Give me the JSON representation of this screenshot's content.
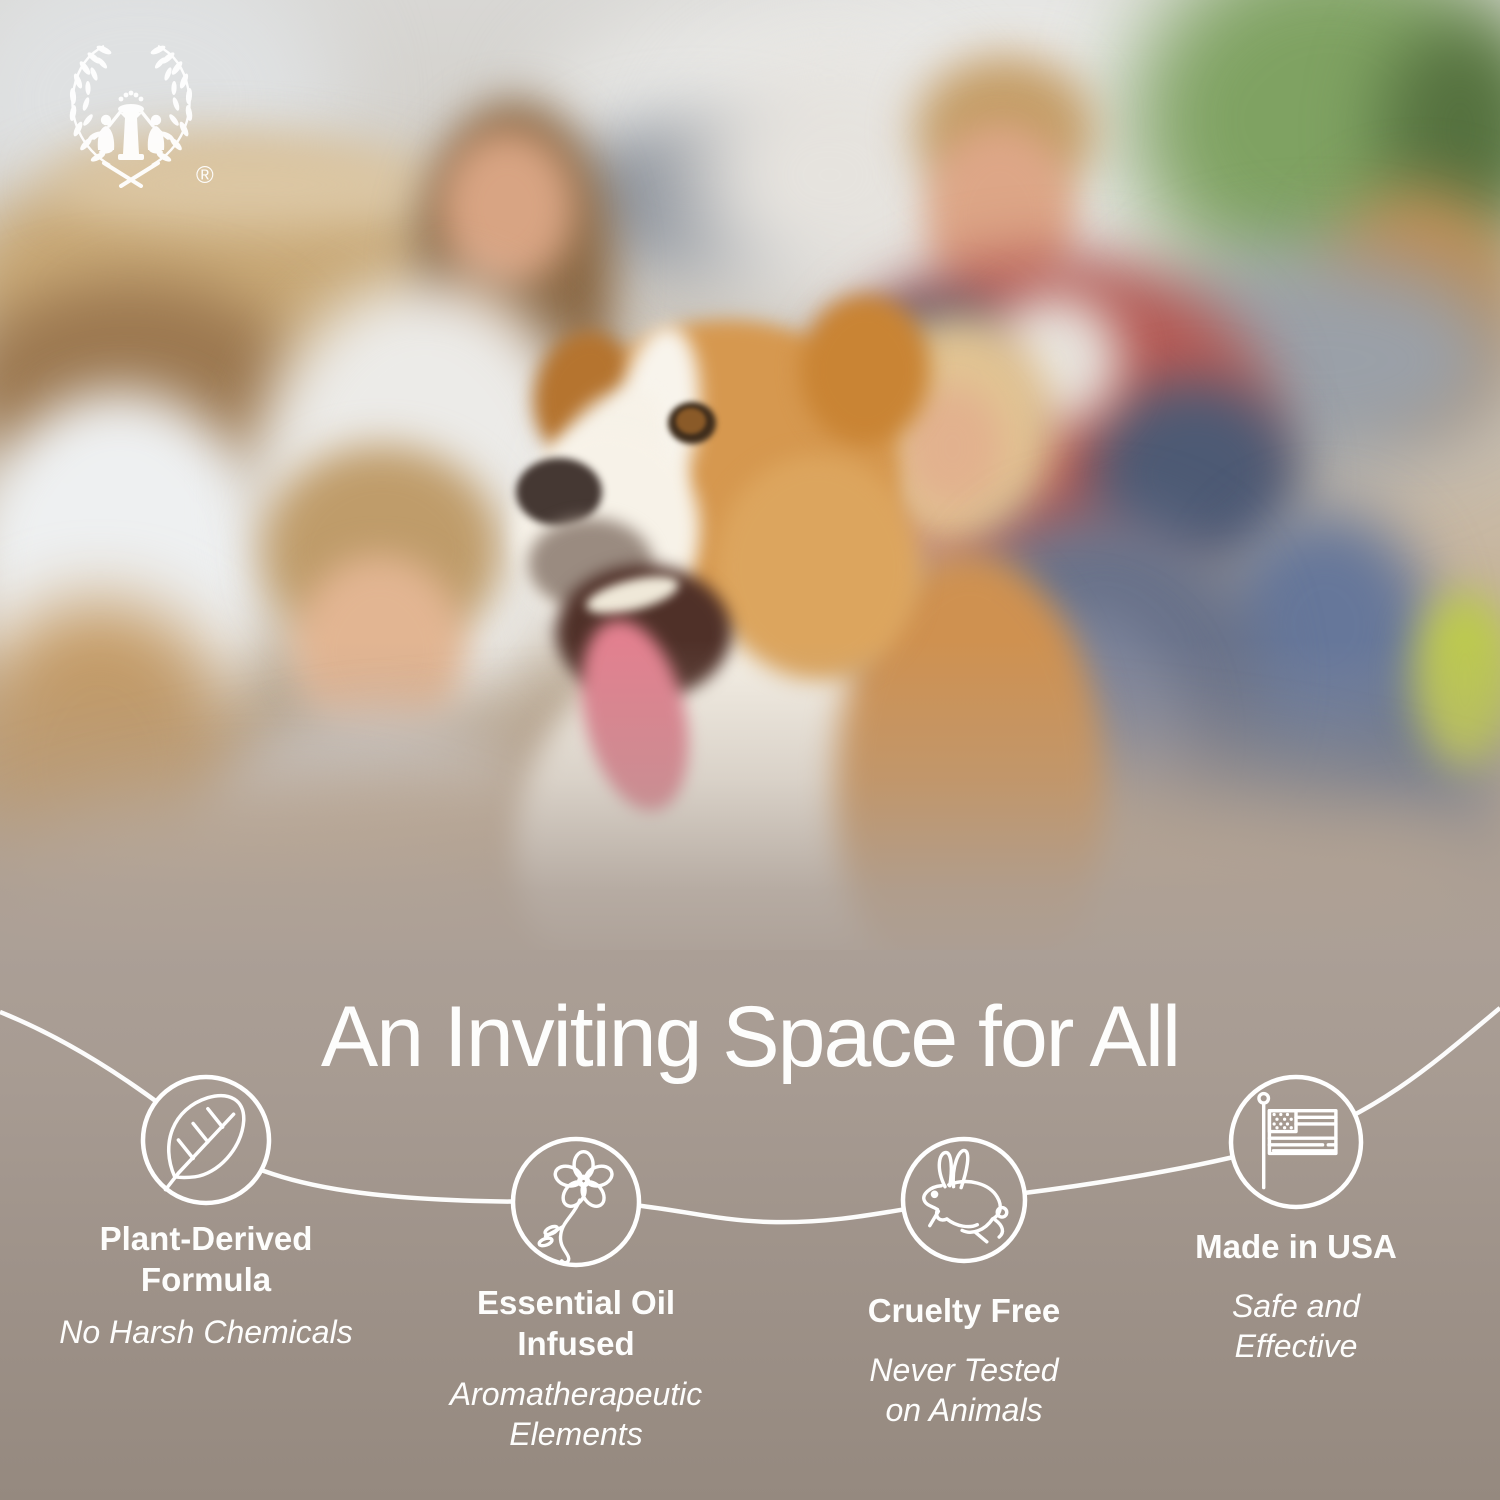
{
  "brand": {
    "logo_icon": "two-figures-laurel-wreath-logo",
    "registered_mark": "®"
  },
  "headline": "An Inviting Space for All",
  "features": [
    {
      "icon": "leaf-icon",
      "title": "Plant-Derived\nFormula",
      "subtitle": "No Harsh Chemicals"
    },
    {
      "icon": "blossom-icon",
      "title": "Essential Oil\nInfused",
      "subtitle": "Aromatherapeutic\nElements"
    },
    {
      "icon": "rabbit-icon",
      "title": "Cruelty Free",
      "subtitle": "Never Tested\non Animals"
    },
    {
      "icon": "usa-flag-icon",
      "title": "Made in USA",
      "subtitle": "Safe and\nEffective"
    }
  ],
  "colors": {
    "band_taupe": "#ab9f96",
    "band_taupe_bottom": "#95897f",
    "line_white": "#ffffff",
    "text_white": "#fdfdfc"
  }
}
